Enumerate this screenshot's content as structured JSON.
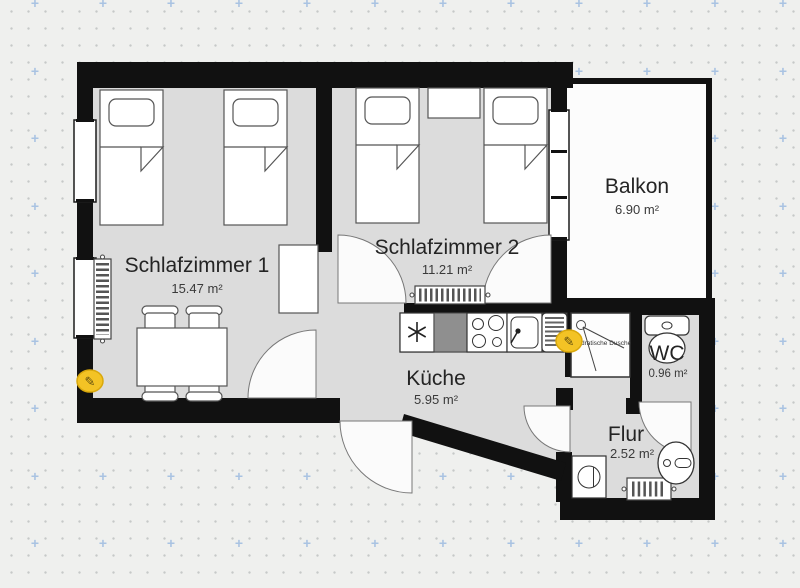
{
  "canvas": {
    "width": 800,
    "height": 588
  },
  "rooms": [
    {
      "name": "Schlafzimmer 1",
      "area": "15.47 m²"
    },
    {
      "name": "Schlafzimmer 2",
      "area": "11.21 m²"
    },
    {
      "name": "Balkon",
      "area": "6.90 m²"
    },
    {
      "name": "Küche",
      "area": "5.95 m²"
    },
    {
      "name": "WC",
      "area": "0.96 m²"
    },
    {
      "name": "Flur",
      "area": "2.52 m²"
    }
  ],
  "fixtures": {
    "shower_label": "Quadratische Dusche"
  },
  "markers": [
    {
      "glyph": "✎"
    },
    {
      "glyph": "✎"
    }
  ],
  "colors": {
    "wall": "#111111",
    "floor": "#dcdcdc",
    "balcony_floor": "#fcfcfc",
    "marker_fill": "#f3c325",
    "marker_stroke": "#d9a80c",
    "grid_plus": "#a9c3e2",
    "background": "#eff0ee"
  }
}
